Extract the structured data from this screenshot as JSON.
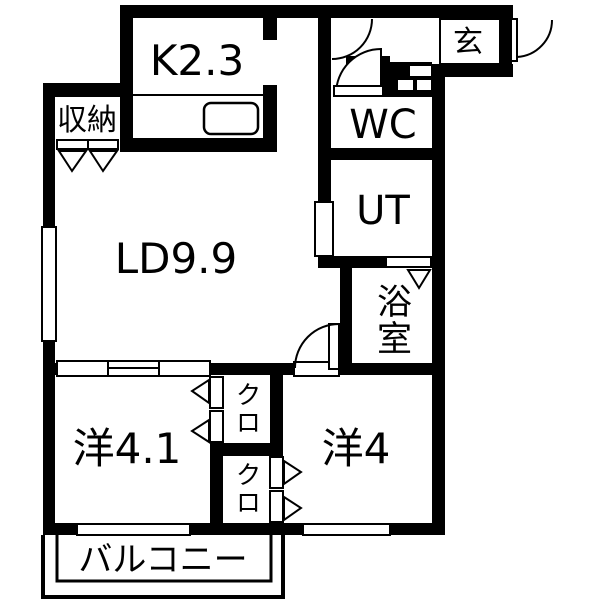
{
  "title": "apartment-floor-plan",
  "colors": {
    "wall": "#000000",
    "floor": "#ffffff",
    "line": "#000000"
  },
  "rooms": {
    "kitchen": {
      "label": "K2.3"
    },
    "living_dining": {
      "label": "LD9.9"
    },
    "storage": {
      "label": "収納"
    },
    "entrance": {
      "label": "玄"
    },
    "toilet": {
      "label": "WC"
    },
    "utility": {
      "label": "UT"
    },
    "bathroom": {
      "label": "浴室"
    },
    "western_room_left": {
      "label": "洋4.1"
    },
    "western_room_right": {
      "label": "洋4"
    },
    "closet_upper": {
      "label": "クロ"
    },
    "closet_lower": {
      "label": "クロ"
    },
    "balcony": {
      "label": "バルコニー"
    }
  }
}
